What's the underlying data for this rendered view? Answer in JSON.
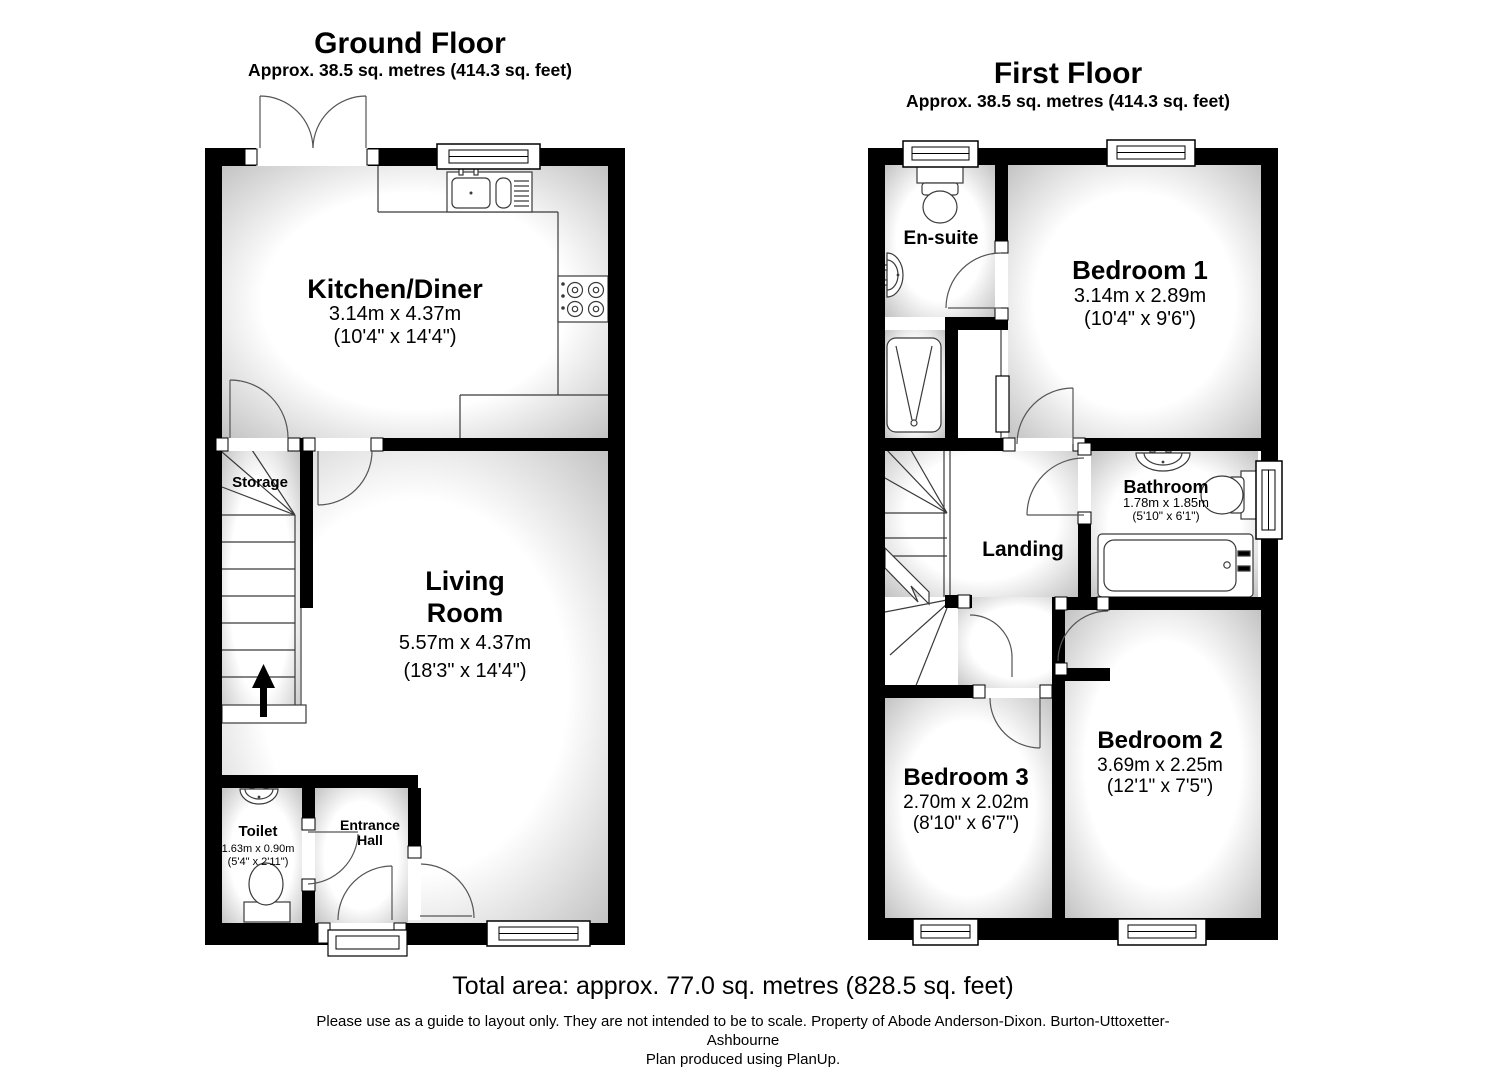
{
  "ground_floor": {
    "title": "Ground Floor",
    "area": "Approx. 38.5 sq. metres (414.3 sq. feet)",
    "rooms": {
      "kitchen": {
        "name": "Kitchen/Diner",
        "metric": "3.14m x 4.37m",
        "imperial": "(10'4\" x 14'4\")"
      },
      "living": {
        "line1": "Living",
        "line2": "Room",
        "metric": "5.57m x 4.37m",
        "imperial": "(18'3\" x 14'4\")"
      },
      "storage": {
        "name": "Storage"
      },
      "toilet": {
        "name": "Toilet",
        "metric": "1.63m x 0.90m",
        "imperial": "(5'4\" x 2'11\")"
      },
      "entrance": {
        "line1": "Entrance",
        "line2": "Hall"
      }
    }
  },
  "first_floor": {
    "title": "First Floor",
    "area": "Approx. 38.5 sq. metres (414.3 sq. feet)",
    "rooms": {
      "ensuite": {
        "name": "En-suite"
      },
      "bedroom1": {
        "name": "Bedroom 1",
        "metric": "3.14m x 2.89m",
        "imperial": "(10'4\" x 9'6\")"
      },
      "bathroom": {
        "name": "Bathroom",
        "metric": "1.78m x 1.85m",
        "imperial": "(5'10\" x 6'1\")"
      },
      "landing": {
        "name": "Landing"
      },
      "bedroom2": {
        "name": "Bedroom 2",
        "metric": "3.69m x 2.25m",
        "imperial": "(12'1\" x 7'5\")"
      },
      "bedroom3": {
        "name": "Bedroom 3",
        "metric": "2.70m x 2.02m",
        "imperial": "(8'10\" x 6'7\")"
      }
    }
  },
  "footer": {
    "total_area": "Total area: approx. 77.0 sq. metres (828.5 sq. feet)",
    "disclaimer_line1": "Please use as a guide to layout only. They are not intended to be to scale. Property of Abode Anderson-Dixon. Burton-Uttoxetter-",
    "disclaimer_line2": "Ashbourne",
    "credit": "Plan produced using PlanUp."
  },
  "colors": {
    "wall": "#000000",
    "shade_edge": "#c0c0c0",
    "thin_line": "#3a3a3a",
    "arc": "#555555"
  }
}
